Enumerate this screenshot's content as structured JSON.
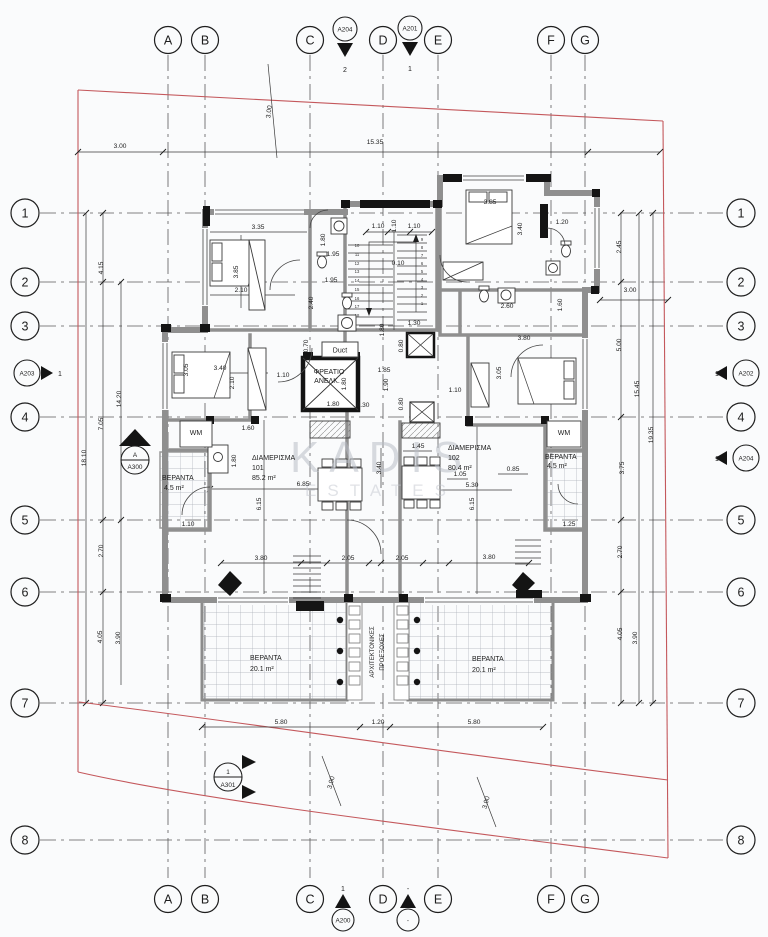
{
  "grid": {
    "cols": [
      "A",
      "B",
      "C",
      "D",
      "E",
      "F",
      "G"
    ],
    "rows": [
      "1",
      "2",
      "3",
      "4",
      "5",
      "6",
      "7",
      "8"
    ]
  },
  "markers": {
    "top": [
      {
        "label": "A204",
        "num": "2"
      },
      {
        "label": "A201",
        "num": "1"
      }
    ],
    "bottom": [
      {
        "label": "A200",
        "num": "1"
      },
      {
        "label": "-",
        "num": "-"
      }
    ],
    "left": [
      {
        "label": "A203",
        "num": "1"
      },
      {
        "label": "A300",
        "num": "A"
      }
    ],
    "right": [
      {
        "label": "A202",
        "num": "1"
      },
      {
        "label": "A204",
        "num": "1"
      }
    ],
    "a301": {
      "label": "A301",
      "num": "1"
    }
  },
  "rooms": {
    "apt101": [
      "ΔΙΑΜΕΡΙΣΜΑ",
      "101",
      "85.2 m²"
    ],
    "apt102": [
      "ΔΙΑΜΕΡΙΣΜΑ",
      "102",
      "80.4 m²"
    ],
    "veranda_small_left": [
      "ΒΕΡΑΝΤΑ",
      "4.5 m²"
    ],
    "veranda_small_right": [
      "ΒΕΡΑΝΤΑ",
      "4.5 m²"
    ],
    "veranda_left": [
      "ΒΕΡΑΝΤΑ",
      "20.1 m²"
    ],
    "veranda_right": [
      "ΒΕΡΑΝΤΑ",
      "20.1 m²"
    ],
    "duct": "Duct",
    "elevator": [
      "ΦΡΕΑΤΙΟ",
      "ΑΝΕΛΚ."
    ],
    "wm_left": "WM",
    "wm_right": "WM",
    "arch_projections": [
      "ΑΡΧΙΤΕΚΤΟΝΙΚΕΣ",
      "ΠΡΟΕΞΟΧΕΣ"
    ]
  },
  "watermark": [
    "KADIS",
    "ESTATES"
  ],
  "stairs": {
    "left": [
      "10",
      "11",
      "12",
      "13",
      "14",
      "15",
      "16",
      "17",
      "18"
    ],
    "right": [
      "9",
      "8",
      "7",
      "6",
      "5",
      "4",
      "3",
      "2",
      "1"
    ]
  },
  "dims": [
    "3.00",
    "15.35",
    "3.00",
    "2.45",
    "3.00",
    "5.00",
    "15.45",
    "19.35",
    "3.75",
    "2.70",
    "4.05",
    "3.90",
    "4.15",
    "7.05",
    "14.20",
    "18.10",
    "2.70",
    "4.05",
    "3.90",
    "3.35",
    "3.85",
    "2.10",
    "1.80",
    "1.95",
    "1.95",
    "2.40",
    "1.10",
    "1.10",
    "1.10",
    "0.10",
    "1.30",
    "1.80",
    "3.85",
    "3.40",
    "1.20",
    "2.60",
    "1.60",
    "0.70",
    "0.80",
    "1.85",
    "1.90",
    "1.80",
    "1.80",
    "0.30",
    "0.80",
    "1.10",
    "3.05",
    "3.40",
    "2.10",
    "1.10",
    "1.60",
    "1.80",
    "6.85",
    "6.15",
    "1.10",
    "1.45",
    "3.40",
    "1.05",
    "5.30",
    "0.85",
    "6.15",
    "1.25",
    "3.80",
    "3.05",
    "3.80",
    "2.05",
    "2.05",
    "3.80",
    "5.80",
    "1.20",
    "5.80",
    "3.00",
    "3.00"
  ],
  "colors": {
    "boundary_red": "#c4585c",
    "wall_gray": "#8f8f8f",
    "black": "#141414"
  }
}
